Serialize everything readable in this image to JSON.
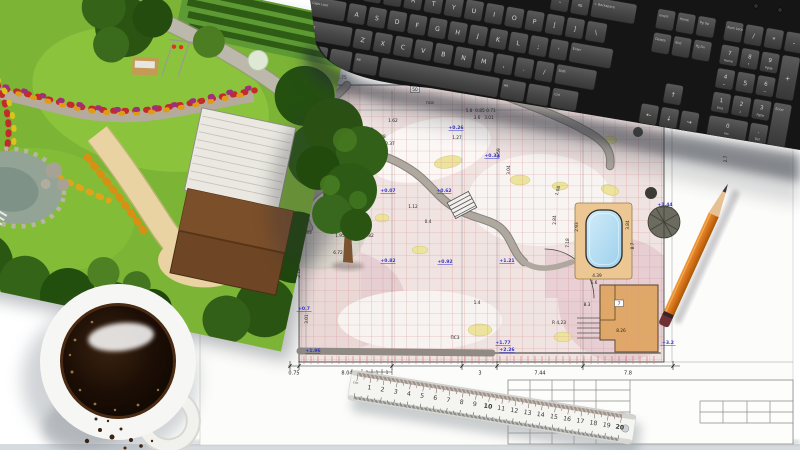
{
  "scene": {
    "desk_color": "#ffffff",
    "desk_edge_color": "#d5dbdf",
    "sheet_color": "#fcfcfa"
  },
  "keyboard": {
    "body_color": "#151515",
    "key_color": "#484848",
    "key_text_color": "#c9c9c7",
    "rows": [
      {
        "x": 237,
        "y": -44,
        "keys": [
          {
            "t": "-"
          },
          {
            "t": "="
          },
          {
            "t": "← Backspace",
            "w": 2.3,
            "small": true
          }
        ]
      },
      {
        "x": 0,
        "y": -20,
        "keys": [
          {
            "t": "Tab",
            "w": 1.5,
            "small": true
          },
          {
            "t": "Q"
          },
          {
            "t": "W"
          },
          {
            "t": "E"
          },
          {
            "t": "R"
          },
          {
            "t": "T"
          },
          {
            "t": "Y"
          },
          {
            "t": "U"
          },
          {
            "t": "I"
          },
          {
            "t": "O"
          },
          {
            "t": "P"
          },
          {
            "t": "["
          },
          {
            "t": "]"
          },
          {
            "t": "\\",
            "w": 1.1
          }
        ]
      },
      {
        "x": 0,
        "y": 4,
        "keys": [
          {
            "t": "Caps Lock",
            "w": 1.9,
            "small": true
          },
          {
            "t": "A"
          },
          {
            "t": "S"
          },
          {
            "t": "D"
          },
          {
            "t": "F"
          },
          {
            "t": "G"
          },
          {
            "t": "H"
          },
          {
            "t": "J"
          },
          {
            "t": "K"
          },
          {
            "t": "L"
          },
          {
            "t": ";"
          },
          {
            "t": "'"
          },
          {
            "t": "Enter",
            "w": 2.2,
            "small": true
          }
        ]
      },
      {
        "x": 0,
        "y": 28,
        "keys": [
          {
            "t": "Shift",
            "w": 2.4,
            "small": true
          },
          {
            "t": "Z"
          },
          {
            "t": "X"
          },
          {
            "t": "C"
          },
          {
            "t": "V"
          },
          {
            "t": "B"
          },
          {
            "t": "N"
          },
          {
            "t": "M"
          },
          {
            "t": ","
          },
          {
            "t": "."
          },
          {
            "t": "/"
          },
          {
            "t": "Shift",
            "w": 2.1,
            "small": true
          }
        ]
      },
      {
        "x": 0,
        "y": 52,
        "keys": [
          {
            "t": "Ctrl",
            "w": 1.4,
            "small": true
          },
          {
            "t": "",
            "w": 1.2
          },
          {
            "t": "Alt",
            "w": 1.3,
            "small": true
          },
          {
            "t": "",
            "w": 6.0
          },
          {
            "t": "Alt",
            "w": 1.3,
            "small": true
          },
          {
            "t": "",
            "w": 1.2
          },
          {
            "t": "Ctrl",
            "w": 1.4,
            "small": true
          }
        ]
      },
      {
        "x": 344,
        "y": -44,
        "keys": [
          {
            "t": "Insert",
            "small": true
          },
          {
            "t": "Home",
            "small": true
          },
          {
            "t": "Pg Up",
            "small": true
          }
        ]
      },
      {
        "x": 344,
        "y": -20,
        "keys": [
          {
            "t": "Delete",
            "small": true
          },
          {
            "t": "End",
            "small": true
          },
          {
            "t": "Pg Dn",
            "small": true
          }
        ]
      },
      {
        "x": 364.5,
        "y": 28,
        "keys": [
          {
            "t": "↑"
          }
        ]
      },
      {
        "x": 344,
        "y": 52,
        "keys": [
          {
            "t": "←"
          },
          {
            "t": "↓"
          },
          {
            "t": "→"
          }
        ]
      },
      {
        "x": 413,
        "y": -44,
        "keys": [
          {
            "t": "Num Lock",
            "small": true
          },
          {
            "t": "/"
          },
          {
            "t": "*"
          },
          {
            "t": "-"
          }
        ]
      },
      {
        "x": 413,
        "y": -20,
        "keys": [
          {
            "t": "7",
            "s": "Home"
          },
          {
            "t": "8",
            "s": "↑"
          },
          {
            "t": "9",
            "s": "PgUp"
          },
          {
            "t": "+",
            "h": 2
          }
        ]
      },
      {
        "x": 413,
        "y": 4,
        "keys": [
          {
            "t": "4",
            "s": "←"
          },
          {
            "t": "5"
          },
          {
            "t": "6",
            "s": "→"
          }
        ]
      },
      {
        "x": 413,
        "y": 28,
        "keys": [
          {
            "t": "1",
            "s": "End"
          },
          {
            "t": "2",
            "s": "↓"
          },
          {
            "t": "3",
            "s": "PgDn"
          },
          {
            "t": "Enter",
            "h": 2,
            "small": true
          }
        ]
      },
      {
        "x": 413,
        "y": 52,
        "keys": [
          {
            "t": "0",
            "s": "Ins",
            "w": 2.05
          },
          {
            "t": ".",
            "s": "Del"
          }
        ]
      }
    ]
  },
  "ruler": {
    "unit": "cm",
    "numbers": [
      1,
      2,
      3,
      4,
      5,
      6,
      7,
      8,
      9,
      10,
      11,
      12,
      13,
      14,
      15,
      16,
      17,
      18,
      19,
      20
    ],
    "red_numbers": [
      10,
      20
    ],
    "number_color": "#3a3a3a",
    "red_color": "#c42222",
    "body_color": "#f4f4f1"
  },
  "blueprint": {
    "grid_color": "#d89090",
    "dim_color": "#222222",
    "elevation_color": "#3535cc",
    "pool_color": "#aadcf4",
    "deck_color": "#ecc793",
    "building_color": "#e0a868",
    "dim_labels": [
      {
        "t": "2.75",
        "x": 342,
        "y": 79
      },
      {
        "t": "1.62",
        "x": 393,
        "y": 122
      },
      {
        "t": "псв",
        "x": 430,
        "y": 104
      },
      {
        "t": "50",
        "x": 415,
        "y": 91,
        "box": true
      },
      {
        "t": "2.08",
        "x": 381,
        "y": 138
      },
      {
        "t": "0.37",
        "x": 390,
        "y": 145
      },
      {
        "t": "1.27",
        "x": 457,
        "y": 139
      },
      {
        "t": "5.8",
        "x": 469,
        "y": 112
      },
      {
        "t": "0.85",
        "x": 480,
        "y": 112
      },
      {
        "t": "0.71",
        "x": 491,
        "y": 112
      },
      {
        "t": "3.6",
        "x": 477,
        "y": 119
      },
      {
        "t": "3.01",
        "x": 489,
        "y": 119
      },
      {
        "t": "6.59",
        "x": 500,
        "y": 153,
        "r": 90
      },
      {
        "t": "3.04",
        "x": 510,
        "y": 170,
        "r": 90
      },
      {
        "t": "1.08",
        "x": 559,
        "y": 191,
        "r": 75
      },
      {
        "t": "2.84",
        "x": 556,
        "y": 220,
        "r": 90
      },
      {
        "t": "2.93",
        "x": 578,
        "y": 227,
        "r": 90
      },
      {
        "t": "7.18",
        "x": 569,
        "y": 243,
        "r": 90
      },
      {
        "t": "3.84",
        "x": 629,
        "y": 225,
        "r": 90
      },
      {
        "t": "8.7",
        "x": 634,
        "y": 246,
        "r": 90
      },
      {
        "t": "4.39",
        "x": 597,
        "y": 277
      },
      {
        "t": "5.6",
        "x": 594,
        "y": 284
      },
      {
        "t": "8.3",
        "x": 587,
        "y": 306
      },
      {
        "t": "R 4,23",
        "x": 559,
        "y": 324
      },
      {
        "t": "8.26",
        "x": 621,
        "y": 332
      },
      {
        "t": "3.37",
        "x": 291,
        "y": 204
      },
      {
        "t": "2.05",
        "x": 293,
        "y": 215
      },
      {
        "t": "1.83",
        "x": 307,
        "y": 234
      },
      {
        "t": "1.95",
        "x": 340,
        "y": 237
      },
      {
        "t": "2.95",
        "x": 355,
        "y": 237
      },
      {
        "t": "0.82",
        "x": 369,
        "y": 237
      },
      {
        "t": "4.3",
        "x": 347,
        "y": 210
      },
      {
        "t": "1.12",
        "x": 413,
        "y": 208
      },
      {
        "t": "0.4",
        "x": 428,
        "y": 223
      },
      {
        "t": "6.72",
        "x": 338,
        "y": 254
      },
      {
        "t": "2.12",
        "x": 300,
        "y": 273,
        "r": 90
      },
      {
        "t": "3.01",
        "x": 308,
        "y": 319,
        "r": 90
      },
      {
        "t": "1.4",
        "x": 477,
        "y": 304
      },
      {
        "t": "ПС3",
        "x": 455,
        "y": 339
      },
      {
        "t": "2.7",
        "x": 727,
        "y": 159,
        "r": 90
      },
      {
        "t": "7",
        "x": 619,
        "y": 305,
        "box": true
      }
    ],
    "elev_labels": [
      {
        "t": "+0.02",
        "x": 366,
        "y": 131
      },
      {
        "t": "+0.26",
        "x": 456,
        "y": 129
      },
      {
        "t": "+0.33",
        "x": 492,
        "y": 157
      },
      {
        "t": "+0.07",
        "x": 388,
        "y": 192
      },
      {
        "t": "+0.62",
        "x": 444,
        "y": 192
      },
      {
        "t": "+0.82",
        "x": 388,
        "y": 262
      },
      {
        "t": "+0.92",
        "x": 445,
        "y": 263
      },
      {
        "t": "+1.21",
        "x": 507,
        "y": 262
      },
      {
        "t": "+1.44",
        "x": 665,
        "y": 206
      },
      {
        "t": "+1.77",
        "x": 503,
        "y": 344
      },
      {
        "t": "+2.26",
        "x": 507,
        "y": 351
      },
      {
        "t": "+1.96",
        "x": 313,
        "y": 352
      },
      {
        "t": "+0.7",
        "x": 304,
        "y": 310
      },
      {
        "t": "+3.2",
        "x": 668,
        "y": 344
      }
    ],
    "bottom_dims": [
      {
        "t": "0.75",
        "x": 294
      },
      {
        "t": "8.04",
        "x": 347
      },
      {
        "t": "3",
        "x": 480
      },
      {
        "t": "7.44",
        "x": 540
      },
      {
        "t": "7.8",
        "x": 628
      }
    ],
    "bottom_ticks": [
      290,
      299,
      392,
      462,
      497,
      583,
      673
    ],
    "mini_chain": {
      "labels": [
        "1",
        "1",
        "1",
        "1"
      ],
      "x0": 352,
      "step": 10,
      "y": 372
    }
  },
  "garden": {
    "lawn_color": "#7cb436",
    "path_sand_color": "#e9d3a2",
    "stone_color": "#bdb8ac",
    "roof_color": "#6e4625",
    "flower_colors": [
      "#c32a2a",
      "#e09b16",
      "#a02f7a",
      "#d9c419"
    ]
  },
  "coffee": {
    "mug_color": "#f2f2ef",
    "coffee_color": "#1c0e05"
  },
  "pencil": {
    "body_color": "#e0831f",
    "wood_color": "#e6c193",
    "tip_color": "#3a3632"
  }
}
